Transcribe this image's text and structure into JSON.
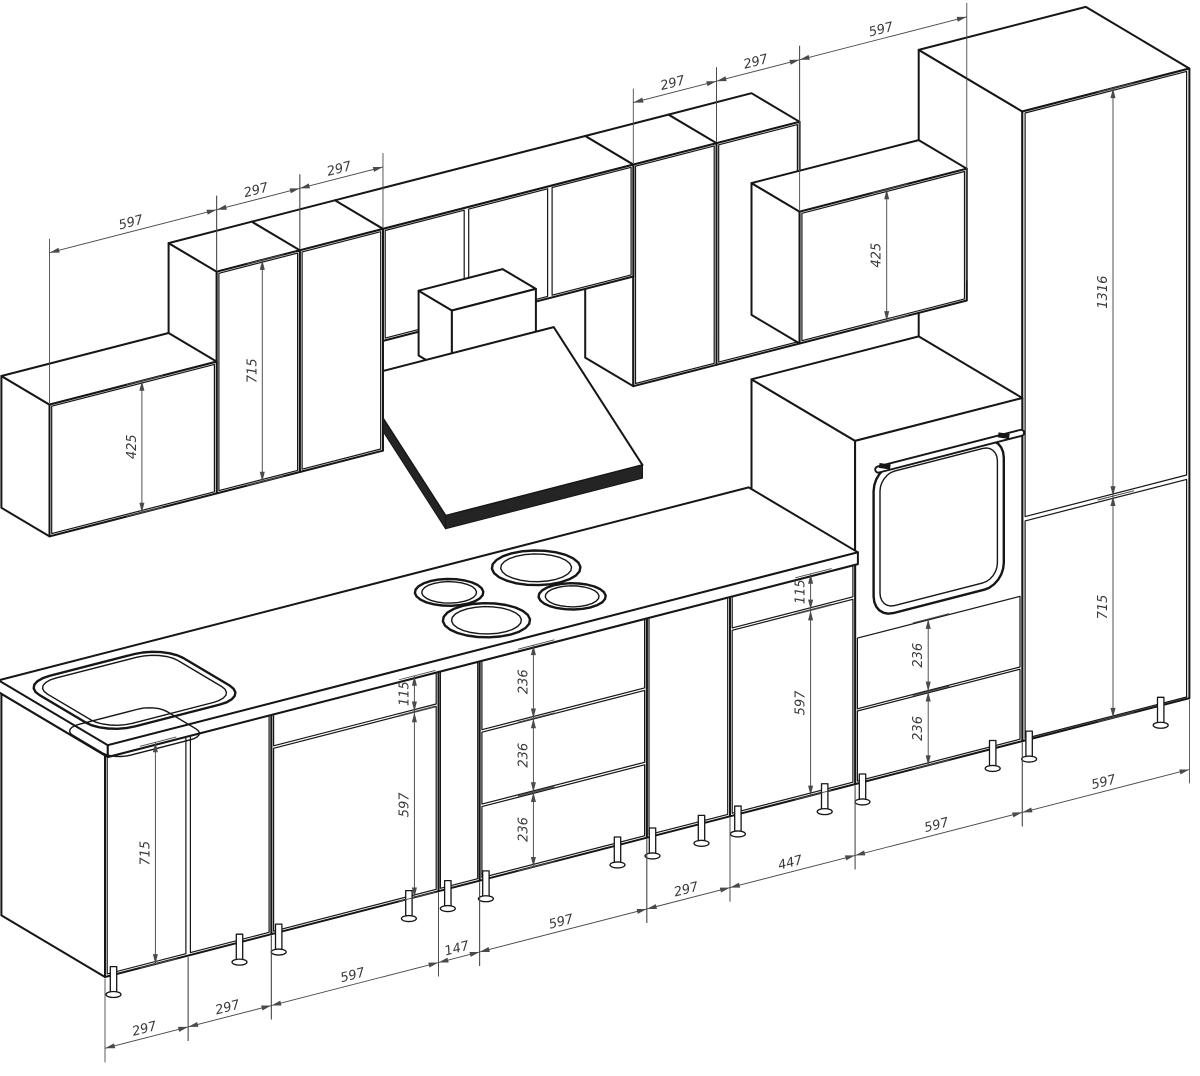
{
  "drawing": {
    "kind": "isometric kitchen cabinet dimension drawing",
    "units": "mm"
  },
  "colors": {
    "background": "#ffffff",
    "line": "#161616",
    "dimension": "#4a4a4a"
  },
  "dims": {
    "b1": "297",
    "b2": "297",
    "b3": "597",
    "b4": "147",
    "b5": "597",
    "b6": "297",
    "b7": "447",
    "b8": "597",
    "b9": "597",
    "t1": "597",
    "t2": "297",
    "t3": "297",
    "t4": "297",
    "t5": "297",
    "t6": "597",
    "h_sink_door": "715",
    "h_a_drawer": "115",
    "h_a_door": "597",
    "h_dr1": "236",
    "h_dr2": "236",
    "h_dr3": "236",
    "h_c_drawer": "115",
    "h_c_door": "597",
    "h_ov1": "236",
    "h_ov2": "236",
    "h_tall_up": "1316",
    "h_tall_low": "715",
    "h_wl": "425",
    "h_wm": "715",
    "h_wr": "425"
  }
}
